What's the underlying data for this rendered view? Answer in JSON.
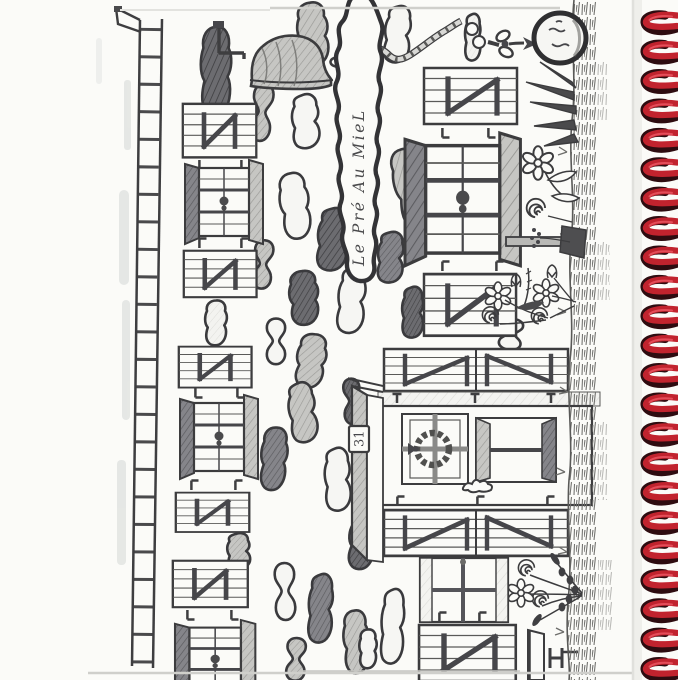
{
  "notebook": {
    "sign_text": "Le Pré Au MieL",
    "house_number": "31"
  },
  "drawing": {
    "medium": "pencil sketch on spiral notebook page",
    "elements": [
      "fence-ladder",
      "hanging-bell",
      "knotted-rope",
      "round-tree",
      "cobblestone-path",
      "sign-stone",
      "shuttered-windows",
      "glazed-doors",
      "barn-shutters",
      "wreath-window",
      "porch-building",
      "house-plaque",
      "grass-strip",
      "daisy-flowers",
      "spiral-flowers",
      "berry-stems",
      "flower-bouquet",
      "lamp-post",
      "bird-splotch",
      "spiral-binding"
    ]
  },
  "binding": {
    "coil_count": 23,
    "coil_color": "#c1232e"
  },
  "colors": {
    "paper": "#fbfbf8",
    "pencil_dark": "#3c3c3e",
    "pencil_mid": "#8a8a88",
    "pencil_light": "#c9c9c6",
    "coil_red": "#c1232e",
    "coil_highlight": "#ea5560",
    "coil_shadow": "#2e0c10",
    "page_edge": "#cfcfcb"
  }
}
